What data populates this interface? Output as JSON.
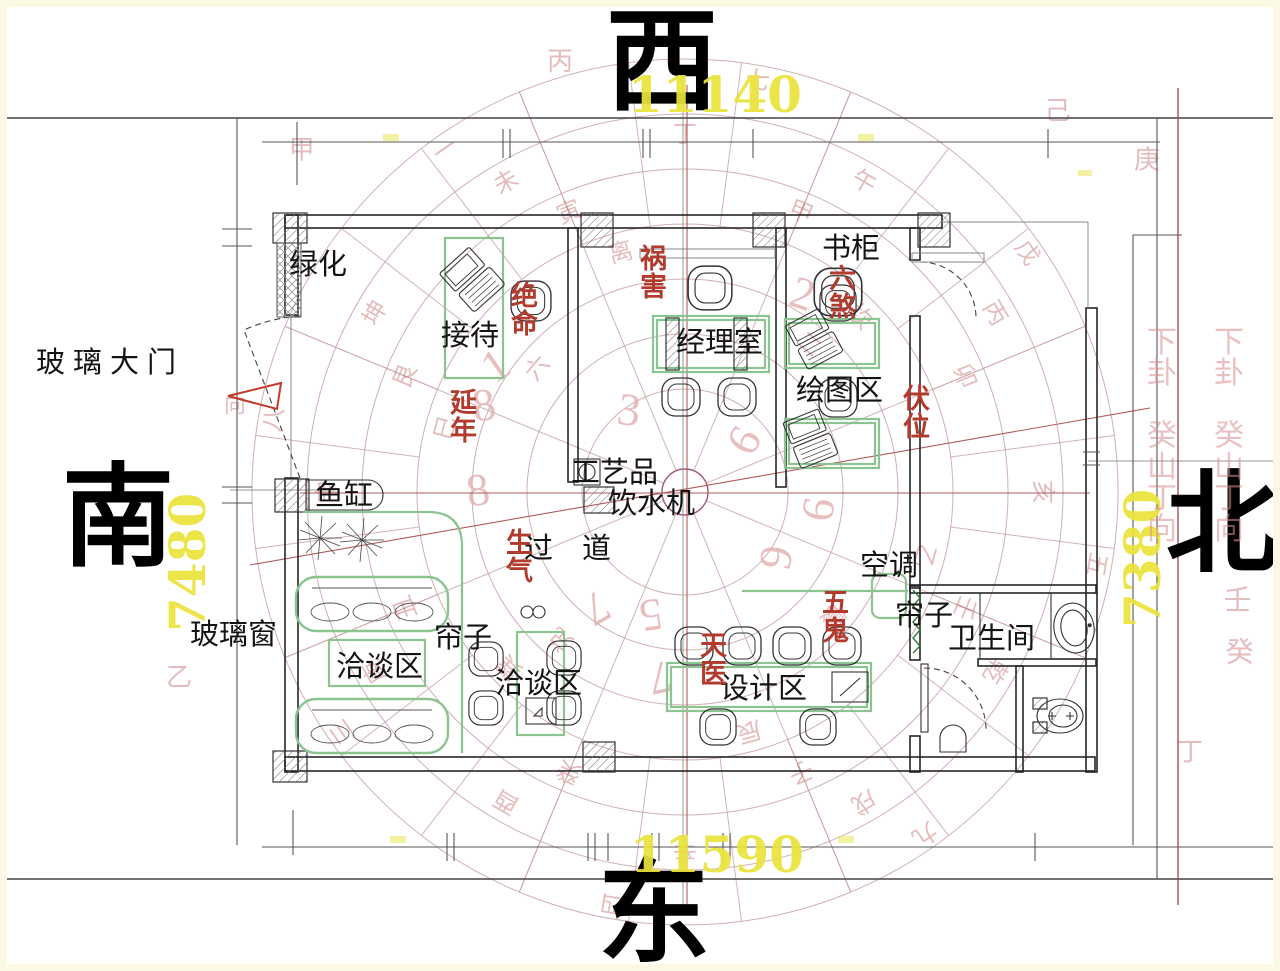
{
  "directions": {
    "top": "西",
    "bottom": "东",
    "left": "南",
    "right": "北"
  },
  "dimensions": {
    "top": "11140",
    "bottom": "11590",
    "left": "7480",
    "right": "7380"
  },
  "rooms": {
    "greenery": "绿化",
    "reception": "接待",
    "manager_office": "经理室",
    "bookcase": "书柜",
    "drawing_area": "绘图区",
    "glass_door": "玻璃大门",
    "fish_tank": "鱼缸",
    "artwork": "工艺品",
    "water_dispenser": "饮水机",
    "corridor": "过　道",
    "air_conditioner": "空调",
    "curtain_bathroom": "帘子",
    "bathroom": "卫生间",
    "glass_window": "玻璃窗",
    "negotiation_area_1": "洽谈区",
    "curtain_lounge": "帘子",
    "negotiation_area_2": "洽谈区",
    "design_area": "设计区"
  },
  "feng_shui_stars": {
    "jueming": "绝命",
    "huohai": "祸害",
    "liusha": "六煞",
    "fuwei": "伏位",
    "yannian": "延年",
    "shengqi": "生气",
    "tianyi": "天医",
    "wugui": "五鬼"
  },
  "side_texts": {
    "column_1": "下卦 癸山丁向",
    "column_2": "下卦 癸山丁向"
  },
  "colors": {
    "dimension_yellow": "#ebe43c",
    "star_red": "#b23b2e",
    "furniture_green": "#8bc48f",
    "compass_rose": "#c59c9c",
    "wall_black": "#262626"
  },
  "compass": {
    "star_numbers": [
      {
        "n": "1",
        "x": 504,
        "y": 378,
        "rot": -35
      },
      {
        "n": "8",
        "x": 486,
        "y": 420,
        "rot": -8
      },
      {
        "n": "8",
        "x": 480,
        "y": 505,
        "rot": -8
      },
      {
        "n": "3",
        "x": 627,
        "y": 425,
        "rot": 8
      },
      {
        "n": "2",
        "x": 798,
        "y": 308,
        "rot": 18
      },
      {
        "n": "6",
        "x": 833,
        "y": 512,
        "rot": -80
      },
      {
        "n": "9",
        "x": 791,
        "y": 560,
        "rot": -80
      },
      {
        "n": "6",
        "x": 757,
        "y": 448,
        "rot": -60
      },
      {
        "n": "7",
        "x": 589,
        "y": 595,
        "rot": 150
      },
      {
        "n": "5",
        "x": 649,
        "y": 600,
        "rot": 172
      },
      {
        "n": "7",
        "x": 657,
        "y": 663,
        "rot": 168
      }
    ],
    "ring_chars": [
      {
        "c": "亥",
        "a": 0,
        "r": 350
      },
      {
        "c": "乾",
        "a": 30,
        "r": 350
      },
      {
        "c": "戌",
        "a": 60,
        "r": 350
      },
      {
        "c": "辛",
        "a": 90,
        "r": 350
      },
      {
        "c": "酉",
        "a": 120,
        "r": 350
      },
      {
        "c": "庚",
        "a": 150,
        "r": 350
      },
      {
        "c": "申",
        "a": 180,
        "r": 350
      },
      {
        "c": "坤",
        "a": 210,
        "r": 350
      },
      {
        "c": "未",
        "a": 240,
        "r": 350
      },
      {
        "c": "丁",
        "a": 270,
        "r": 350
      },
      {
        "c": "午",
        "a": 300,
        "r": 350
      },
      {
        "c": "丙",
        "a": 330,
        "r": 350
      },
      {
        "c": "壬",
        "a": 22.5,
        "r": 295
      },
      {
        "c": "子",
        "a": 67.5,
        "r": 295
      },
      {
        "c": "癸",
        "a": 112.5,
        "r": 295
      },
      {
        "c": "丑",
        "a": 157.5,
        "r": 295
      },
      {
        "c": "艮",
        "a": 202.5,
        "r": 295
      },
      {
        "c": "寅",
        "a": 247.5,
        "r": 295
      },
      {
        "c": "甲",
        "a": 292.5,
        "r": 295
      },
      {
        "c": "卯",
        "a": 337.5,
        "r": 295
      },
      {
        "c": "乙",
        "a": 15,
        "r": 240
      },
      {
        "c": "辰",
        "a": 75,
        "r": 240
      },
      {
        "c": "巽",
        "a": 135,
        "r": 240
      },
      {
        "c": "巳",
        "a": 195,
        "r": 240
      },
      {
        "c": "离",
        "a": 255,
        "r": 240
      },
      {
        "c": "坎",
        "a": 315,
        "r": 240
      },
      {
        "c": "震",
        "a": 40,
        "r": 185
      },
      {
        "c": "兑",
        "a": 130,
        "r": 185
      },
      {
        "c": "六",
        "a": 220,
        "r": 185
      },
      {
        "c": "二",
        "a": 310,
        "r": 185
      },
      {
        "c": "五",
        "a": 10,
        "r": 410
      },
      {
        "c": "九",
        "a": 55,
        "r": 410
      },
      {
        "c": "四",
        "a": 100,
        "r": 410
      },
      {
        "c": "三",
        "a": 145,
        "r": 410
      },
      {
        "c": "八",
        "a": 190,
        "r": 410
      },
      {
        "c": "一",
        "a": 235,
        "r": 410
      },
      {
        "c": "七",
        "a": 280,
        "r": 410
      },
      {
        "c": "戊",
        "a": 325,
        "r": 410
      },
      {
        "c": "向",
        "a": 190,
        "r": 457,
        "rot": 0,
        "s": 22
      },
      {
        "c": "己",
        "a": 315,
        "r": 527,
        "rot": 0,
        "s": 26
      },
      {
        "c": "庚",
        "a": 325,
        "r": 564,
        "rot": 0,
        "s": 26
      },
      {
        "c": "壬",
        "a": 12,
        "r": 565,
        "rot": 0,
        "s": 28
      },
      {
        "c": "癸",
        "a": 17,
        "r": 580,
        "rot": 0,
        "s": 28
      },
      {
        "c": "甲",
        "a": 221,
        "r": 508,
        "rot": 0,
        "s": 26
      },
      {
        "c": "乙",
        "a": 159,
        "r": 542,
        "rot": 0,
        "s": 26
      },
      {
        "c": "丙",
        "a": 253.5,
        "r": 440,
        "rot": 0,
        "s": 26
      },
      {
        "c": "丁",
        "a": 28,
        "r": 572,
        "rot": 0,
        "s": 26
      }
    ]
  }
}
